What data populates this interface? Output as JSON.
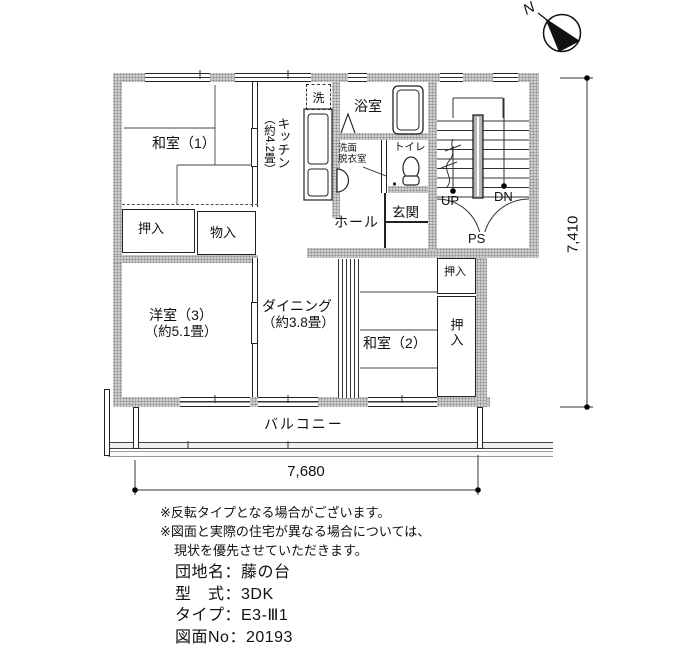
{
  "compass": {
    "north": "N"
  },
  "rooms": {
    "washitsu1": "和室（1）",
    "oshiire_left": "押入",
    "monoire": "物入",
    "yoshitsu3_name": "洋室（3）",
    "yoshitsu3_size": "（約5.1畳）",
    "kitchen_name": "キッチン",
    "kitchen_size": "（約4.2畳）",
    "laundry": "洗",
    "bath": "浴室",
    "washroom_line1": "洗面",
    "washroom_line2": "脱衣室",
    "toilet": "トイレ",
    "hall": "ホール",
    "genkan": "玄関",
    "dining_name": "ダイニング",
    "dining_size": "（約3.8畳）",
    "washitsu2": "和室（2）",
    "oshiire_upper": "押入",
    "oshiire_lower": "押入",
    "balcony": "バルコニー"
  },
  "stairwell": {
    "up": "UP",
    "down": "DN",
    "pipe_space": "PS"
  },
  "dimensions": {
    "width_mm": "7,680",
    "height_mm": "7,410"
  },
  "notes": [
    "※反転タイプとなる場合がございます。",
    "※図面と実際の住宅が異なる場合については、",
    "現状を優先させていただきます。"
  ],
  "info_lines": [
    "団地名：藤の台",
    "型　式：3DK",
    "タイプ：E3-Ⅲ1",
    "図面No：20193"
  ],
  "colors": {
    "wall_fill": "#d0d0d0",
    "line": "#222222",
    "text": "#111111"
  }
}
